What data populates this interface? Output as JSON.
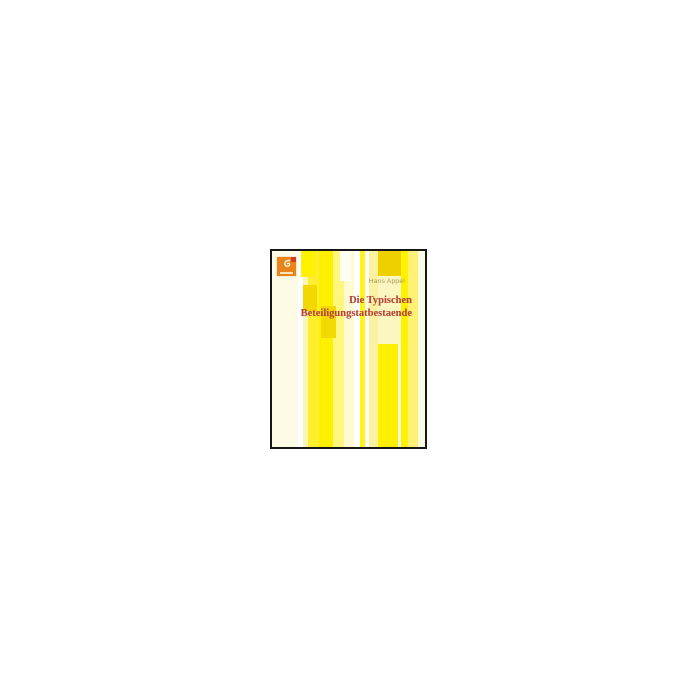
{
  "page": {
    "background_color": "#ffffff",
    "description_label": ""
  },
  "book_cover": {
    "author": "Hans Appel",
    "title_line1": "Die Typischen",
    "title_line2": "Beteiligungstatbestaende",
    "title_color": "#b5443a",
    "author_color": "#a39557",
    "border_color": "#161616",
    "publisher_logo": {
      "background_color": "#e8841c",
      "accent_color": "#d43b20",
      "glyph_color": "#fdf3d7"
    },
    "stripes": [
      {
        "x": 0,
        "w": 26,
        "color": "#fdfbe6"
      },
      {
        "x": 26,
        "w": 5,
        "color": "#ffffff"
      },
      {
        "x": 31,
        "w": 5,
        "color": "#fcf5b8"
      },
      {
        "x": 36,
        "w": 11,
        "color": "#ffee2e"
      },
      {
        "x": 47,
        "w": 14,
        "color": "#fff000"
      },
      {
        "x": 61,
        "w": 11,
        "color": "#fff67d"
      },
      {
        "x": 72,
        "w": 10,
        "color": "#fefad2"
      },
      {
        "x": 82,
        "w": 6,
        "color": "#ffffff"
      },
      {
        "x": 88,
        "w": 5,
        "color": "#fff31c"
      },
      {
        "x": 93,
        "w": 4,
        "color": "#fffef4"
      },
      {
        "x": 97,
        "w": 9,
        "color": "#faf2a0"
      },
      {
        "x": 106,
        "w": 20,
        "color": "#fff000"
      },
      {
        "x": 126,
        "w": 3,
        "color": "#fffbd8"
      },
      {
        "x": 129,
        "w": 7,
        "color": "#fff200"
      },
      {
        "x": 136,
        "w": 10,
        "color": "#fff175"
      },
      {
        "x": 146,
        "w": 7,
        "color": "#fdfae2"
      }
    ],
    "blocks": [
      {
        "x": 106,
        "y": 0,
        "w": 23,
        "h": 25,
        "color": "#eecf00"
      },
      {
        "x": 106,
        "y": 25,
        "w": 23,
        "h": 68,
        "color": "#fcf7c0"
      },
      {
        "x": 29,
        "y": 0,
        "w": 14,
        "h": 26,
        "color": "#fff100"
      },
      {
        "x": 68,
        "y": 0,
        "w": 11,
        "h": 30,
        "color": "#fffef2"
      },
      {
        "x": 31,
        "y": 34,
        "w": 14,
        "h": 26,
        "color": "#f2d800"
      },
      {
        "x": 49,
        "y": 55,
        "w": 15,
        "h": 32,
        "color": "#f2da00"
      }
    ]
  }
}
